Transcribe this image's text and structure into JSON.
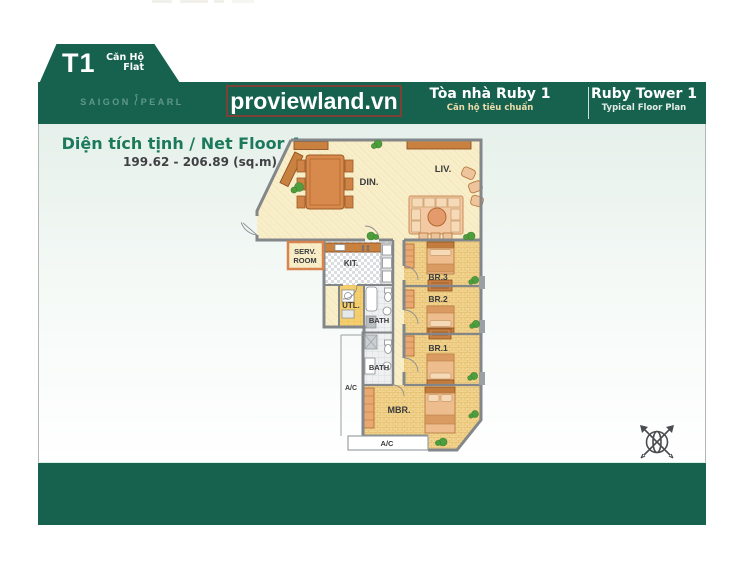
{
  "tab": {
    "code": "T1",
    "type_vi": "Căn Hộ",
    "type_en": "Flat"
  },
  "logo": {
    "word1": "SAIGON",
    "word2": "PEARL"
  },
  "watermark": {
    "text": "proviewland.vn"
  },
  "header": {
    "vi_title": "Tòa nhà Ruby 1",
    "vi_sub": "Căn hộ tiêu chuẩn",
    "en_title": "Ruby Tower 1",
    "en_sub": "Typical Floor Plan"
  },
  "area": {
    "label": "Diện tích tịnh / Net Floor Area:",
    "value": "199.62 - 206.89 (sq.m)"
  },
  "rooms": {
    "din": "DIN.",
    "liv": "LIV.",
    "serv1": "SERV.",
    "serv2": "ROOM",
    "kit": "KIT.",
    "utl": "UTL.",
    "bath_upper": "BATH",
    "bath_lower": "BATH",
    "br3": "BR.3",
    "br2": "BR.2",
    "br1": "BR.1",
    "mbr": "MBR.",
    "ac_side": "A/C",
    "ac_bottom": "A/C"
  },
  "icons": {
    "compass": "compass-rose",
    "plant": "plant"
  },
  "colors": {
    "brand_green": "#17624F",
    "watermark_border": "#7C4136",
    "floor_cream": "#F8EFCA",
    "floor_tan": "#F2D48F",
    "wall_gray": "#83878A",
    "furniture_orange": "#D8894C",
    "plant_green": "#4F9E3D",
    "area_text_green": "#1C7A5C"
  }
}
